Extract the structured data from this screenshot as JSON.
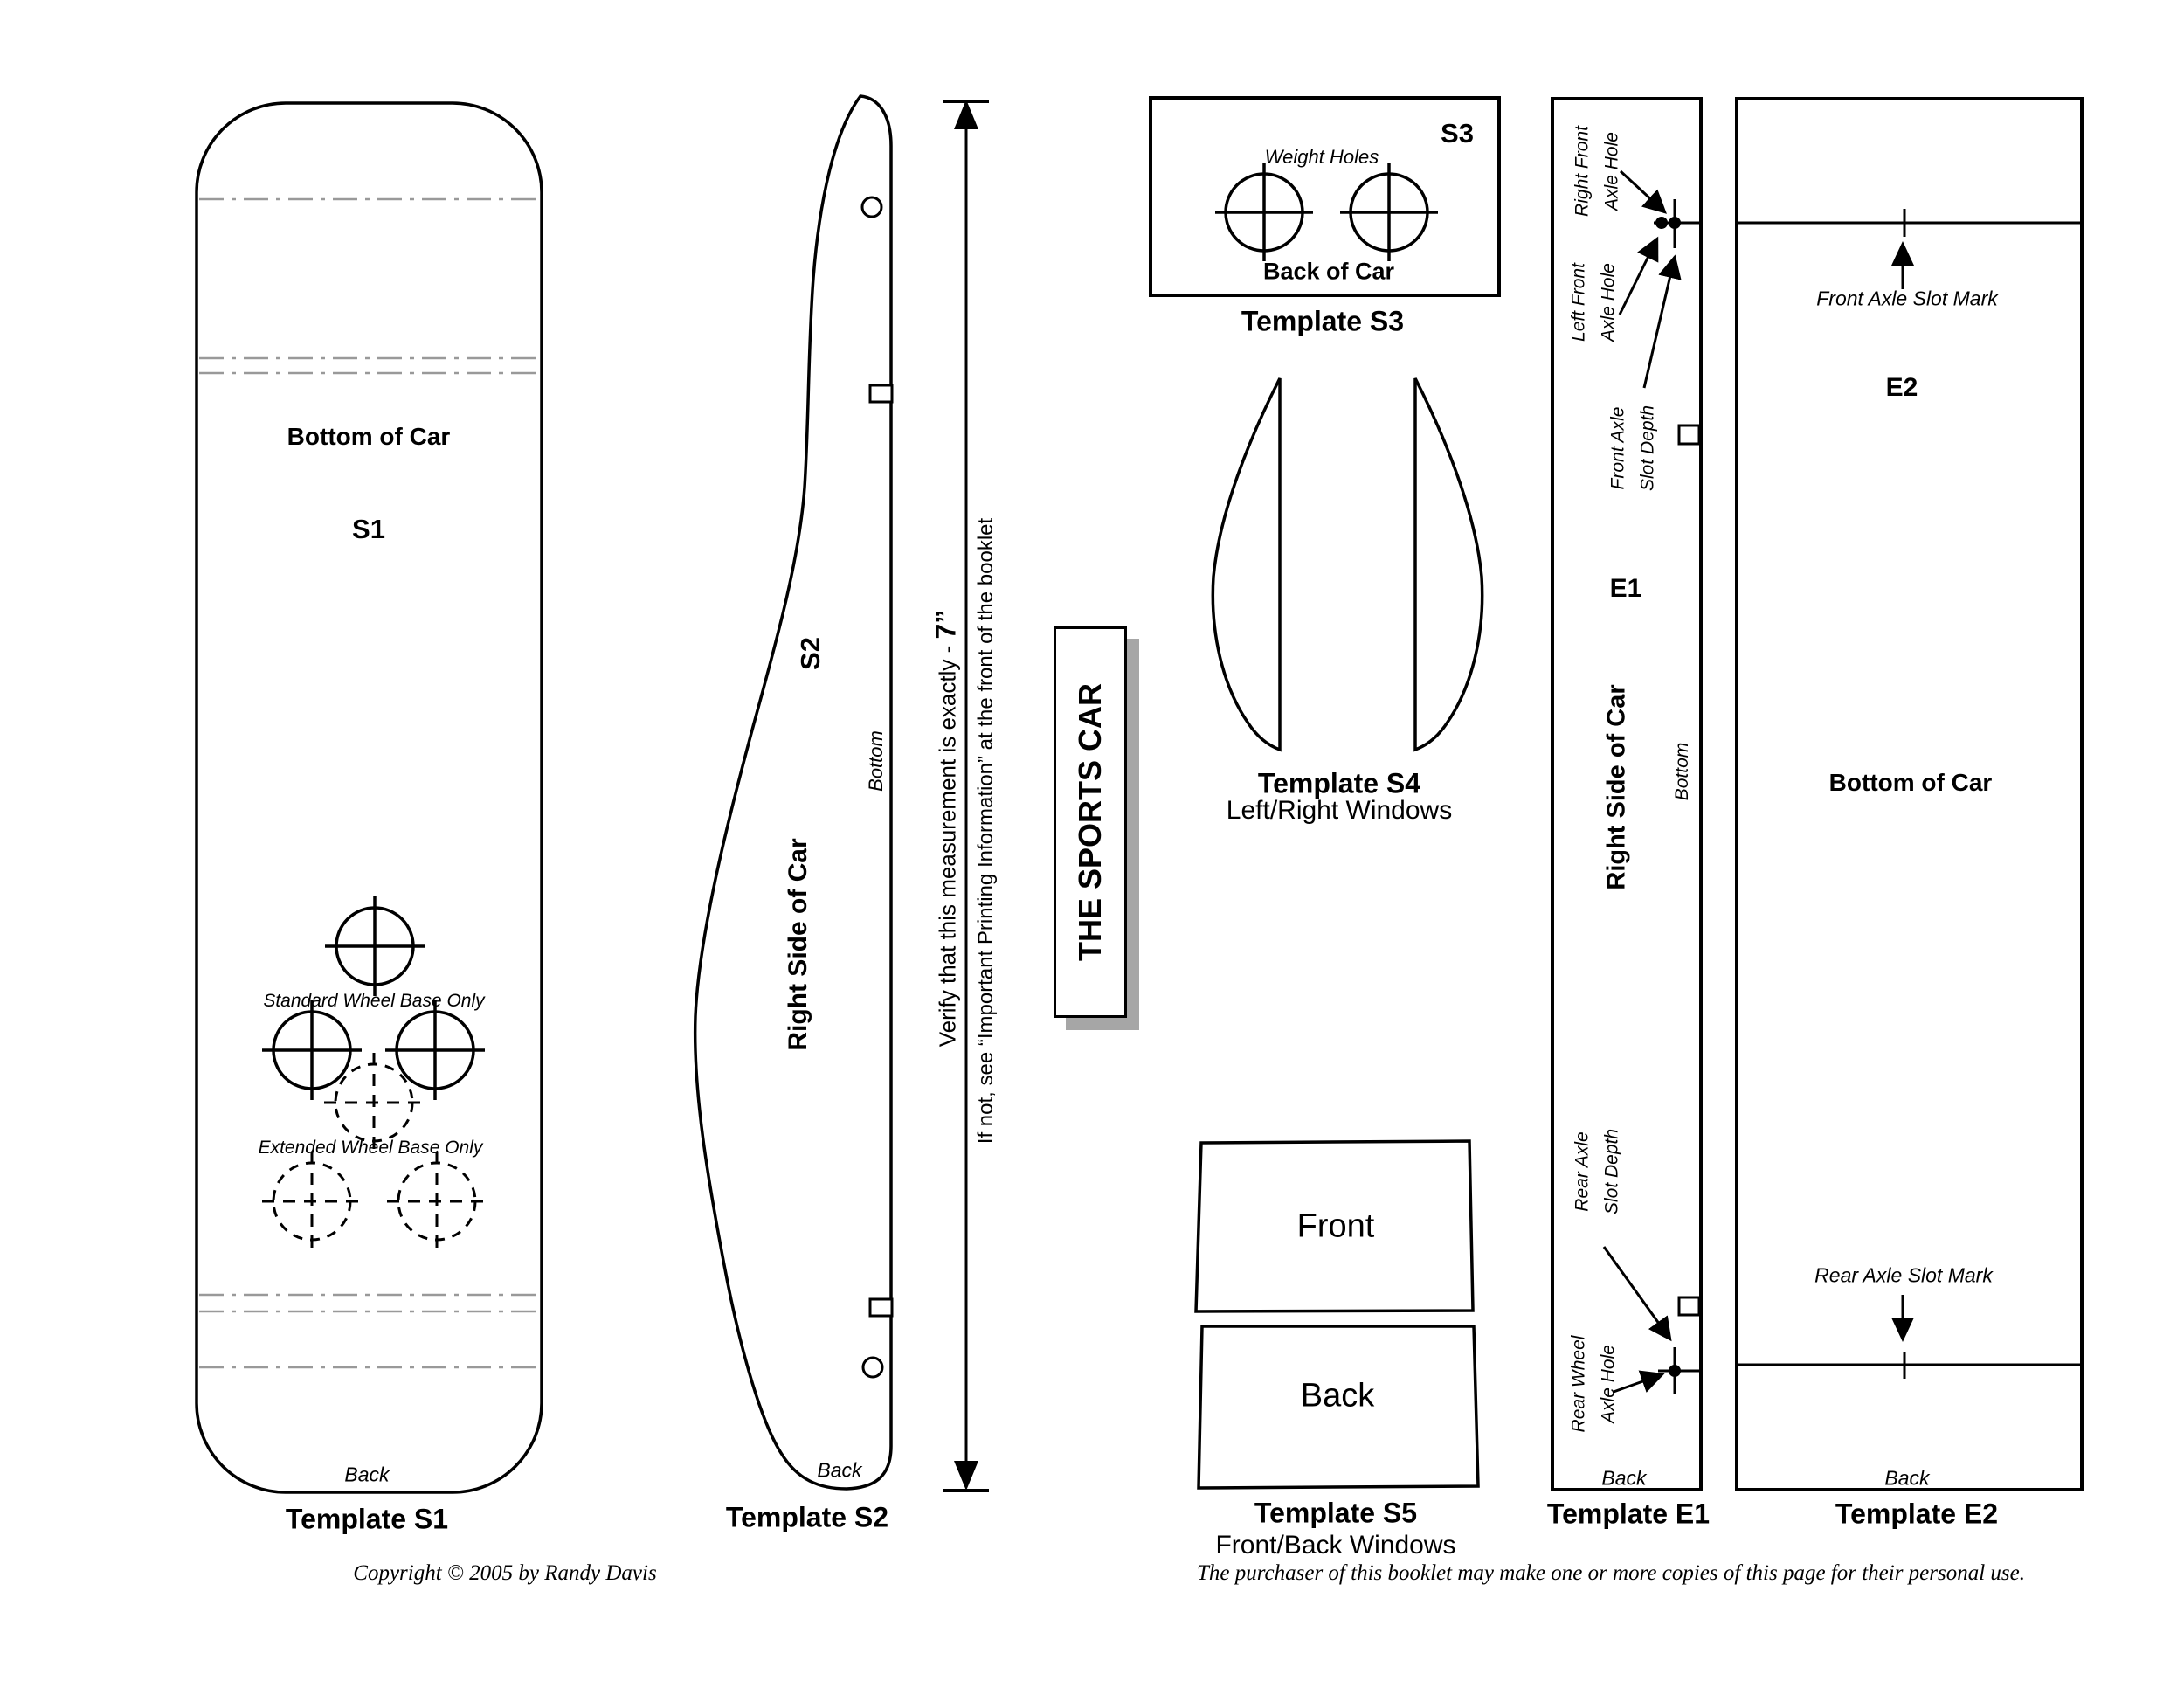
{
  "page": {
    "background": "#ffffff",
    "ink": "#000000",
    "guide_gray": "#999999"
  },
  "s1": {
    "bottom_of_car": "Bottom of Car",
    "label": "S1",
    "standard": "Standard Wheel Base Only",
    "extended": "Extended Wheel Base Only",
    "back": "Back",
    "template": "Template S1"
  },
  "s2": {
    "label": "S2",
    "bottom": "Bottom",
    "right_side": "Right Side of Car",
    "back": "Back",
    "template": "Template S2"
  },
  "measure": {
    "line1_prefix": "Verify that this measurement is exactly - ",
    "line1_value": "7”",
    "line2": "If not, see “Important Printing Information” at the front of the booklet"
  },
  "title_box": {
    "title": "THE SPORTS CAR"
  },
  "s3": {
    "label": "S3",
    "weight_holes": "Weight Holes",
    "back_of_car": "Back of Car",
    "template": "Template S3"
  },
  "s4": {
    "template": "Template S4",
    "subtitle": "Left/Right Windows"
  },
  "s5": {
    "front": "Front",
    "back": "Back",
    "template": "Template S5",
    "subtitle": "Front/Back Windows"
  },
  "e1": {
    "right_front_l1": "Right Front",
    "right_front_l2": "Axle Hole",
    "left_front_l1": "Left Front",
    "left_front_l2": "Axle Hole",
    "front_axle_l1": "Front Axle",
    "front_axle_l2": "Slot Depth",
    "label": "E1",
    "right_side": "Right Side of Car",
    "bottom": "Bottom",
    "rear_axle_l1": "Rear Axle",
    "rear_axle_l2": "Slot Depth",
    "rear_wheel_l1": "Rear Wheel",
    "rear_wheel_l2": "Axle Hole",
    "back": "Back",
    "template": "Template E1"
  },
  "e2": {
    "front_mark": "Front Axle Slot Mark",
    "label": "E2",
    "bottom_of_car": "Bottom of Car",
    "rear_mark": "Rear Axle Slot Mark",
    "back": "Back",
    "template": "Template E2"
  },
  "footer": {
    "copyright": "Copyright © 2005 by Randy Davis",
    "license": "The purchaser of this booklet may make one or more copies of this page for their personal use."
  }
}
